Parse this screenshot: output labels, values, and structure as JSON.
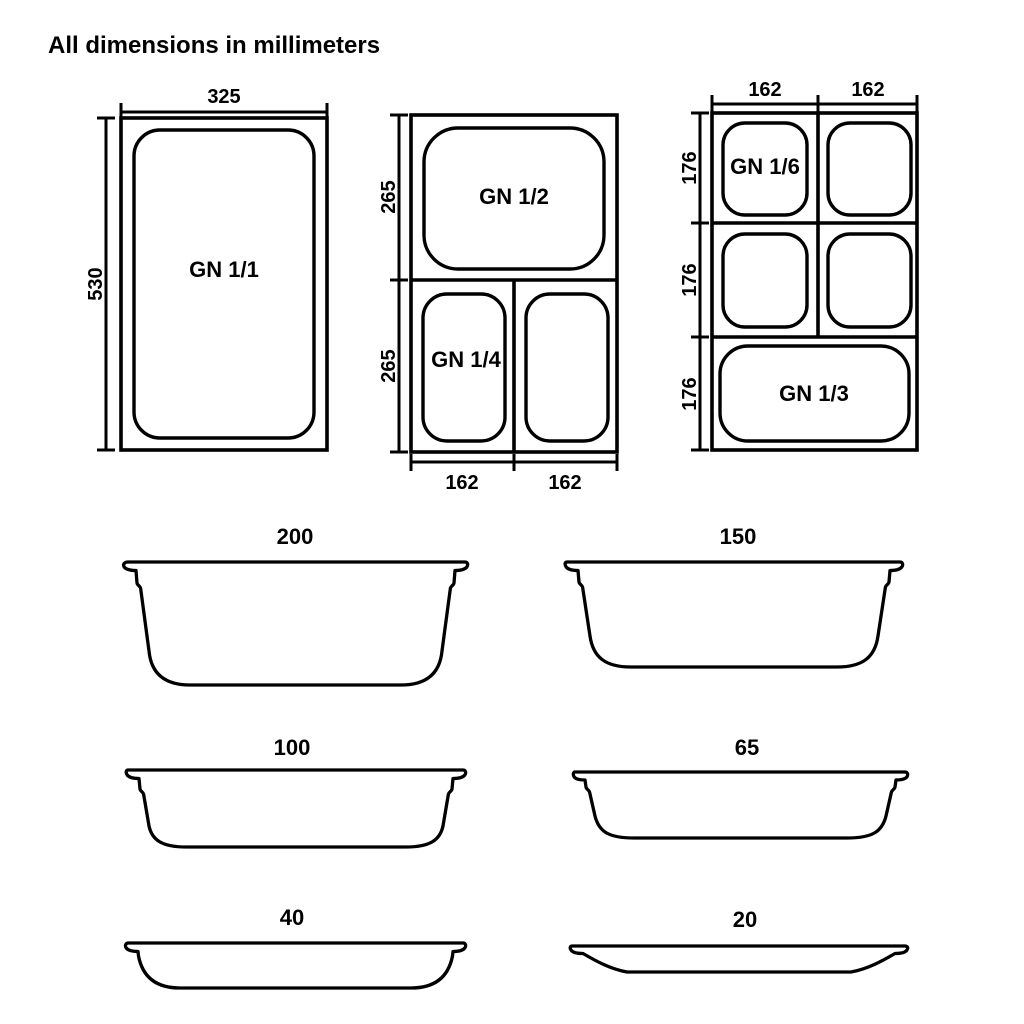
{
  "title": "All dimensions in millimeters",
  "diagrams": {
    "gn_1_1": {
      "label": "GN 1/1",
      "width_mm": "325",
      "height_mm": "530"
    },
    "gn_half_quarter": {
      "gn12_label": "GN 1/2",
      "gn14_label": "GN 1/4",
      "height_top_mm": "265",
      "height_bottom_mm": "265",
      "width_left_mm": "162",
      "width_right_mm": "162"
    },
    "gn_sixth_third": {
      "gn16_label": "GN 1/6",
      "gn13_label": "GN 1/3",
      "width_col1_mm": "162",
      "width_col2_mm": "162",
      "height_row1_mm": "176",
      "height_row2_mm": "176",
      "height_row3_mm": "176"
    }
  },
  "profiles": [
    {
      "depth_mm": "200"
    },
    {
      "depth_mm": "150"
    },
    {
      "depth_mm": "100"
    },
    {
      "depth_mm": "65"
    },
    {
      "depth_mm": "40"
    },
    {
      "depth_mm": "20"
    }
  ]
}
